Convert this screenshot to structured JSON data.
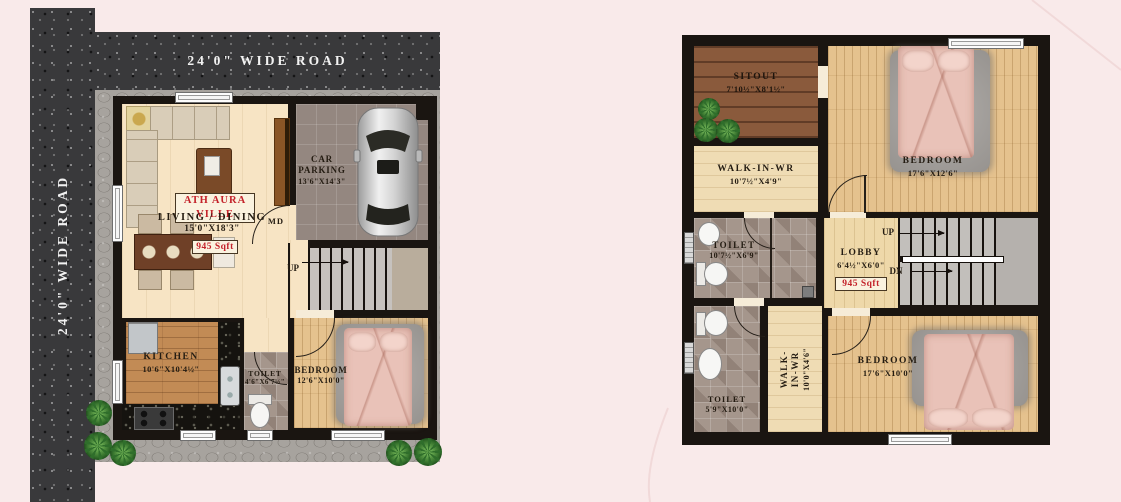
{
  "colors": {
    "background": "#f9eaea",
    "road": "#39393b",
    "wall": "#1a1511",
    "accent_red": "#c3222a",
    "paver": "#a7a39e"
  },
  "roads": {
    "top_label": "24'0\" WIDE ROAD",
    "left_label": "24'0\" WIDE ROAD"
  },
  "ground_floor": {
    "brand": "ATH AURA VILLE",
    "living": {
      "label": "LIVING / DINING",
      "dims": "15'0\"X18'3\"",
      "area": "945 Sqft"
    },
    "main_door": "MD",
    "car_parking": {
      "label": "CAR PARKING",
      "dims": "13'6\"X14'3\""
    },
    "stairs": {
      "up": "UP"
    },
    "kitchen": {
      "label": "KITCHEN",
      "dims": "10'6\"X10'4½\""
    },
    "toilet": {
      "label": "TOILET",
      "dims": "4'6\"X6'7½\""
    },
    "bedroom": {
      "label": "BEDROOM",
      "dims": "12'6\"X10'0\""
    }
  },
  "first_floor": {
    "sitout": {
      "label": "SITOUT",
      "dims": "7'10½\"X8'1½\""
    },
    "bedroom_top": {
      "label": "BEDROOM",
      "dims": "17'6\"X12'6\""
    },
    "walk_in_wr_top": {
      "label": "WALK-IN-WR",
      "dims": "10'7½\"X4'9\""
    },
    "toilet_top": {
      "label": "TOILET",
      "dims": "10'7½\"X6'9\""
    },
    "lobby": {
      "label": "LOBBY",
      "dims": "6'4½\"X6'0\"",
      "area": "945 Sqft"
    },
    "stairs": {
      "up": "UP",
      "dn": "DN"
    },
    "toilet_bottom": {
      "label": "TOILET",
      "dims": "5'9\"X10'0\""
    },
    "walk_in_wr_bottom": {
      "label": "WALK-IN-WR",
      "dims": "10'0\"X4'6\""
    },
    "bedroom_bottom": {
      "label": "BEDROOM",
      "dims": "17'6\"X10'0\""
    }
  }
}
